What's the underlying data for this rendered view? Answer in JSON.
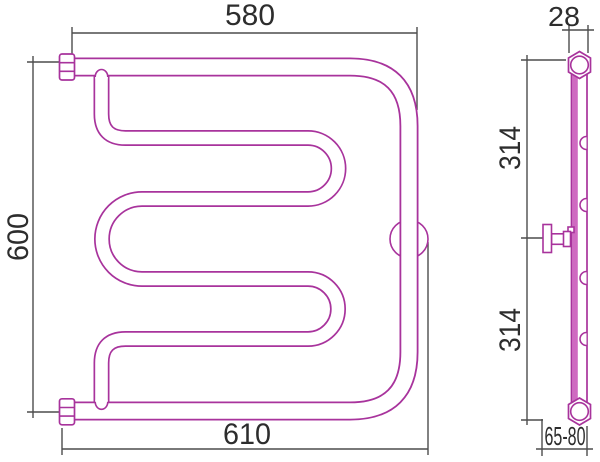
{
  "drawing": {
    "type": "technical-drawing",
    "subject": "towel-rail-radiator",
    "dimensions": {
      "front": {
        "top_width": "580",
        "height": "600",
        "bottom_width": "610"
      },
      "side": {
        "pipe_width": "28",
        "upper_span": "314",
        "lower_span": "314",
        "wall_distance": "65-80"
      }
    },
    "colors": {
      "pipe_outline": "#a8339c",
      "pipe_fill": "#cf6ac1",
      "dimension_lines": "#4d4d4d",
      "dimension_text": "#2d2d2d",
      "background": "#ffffff"
    }
  }
}
